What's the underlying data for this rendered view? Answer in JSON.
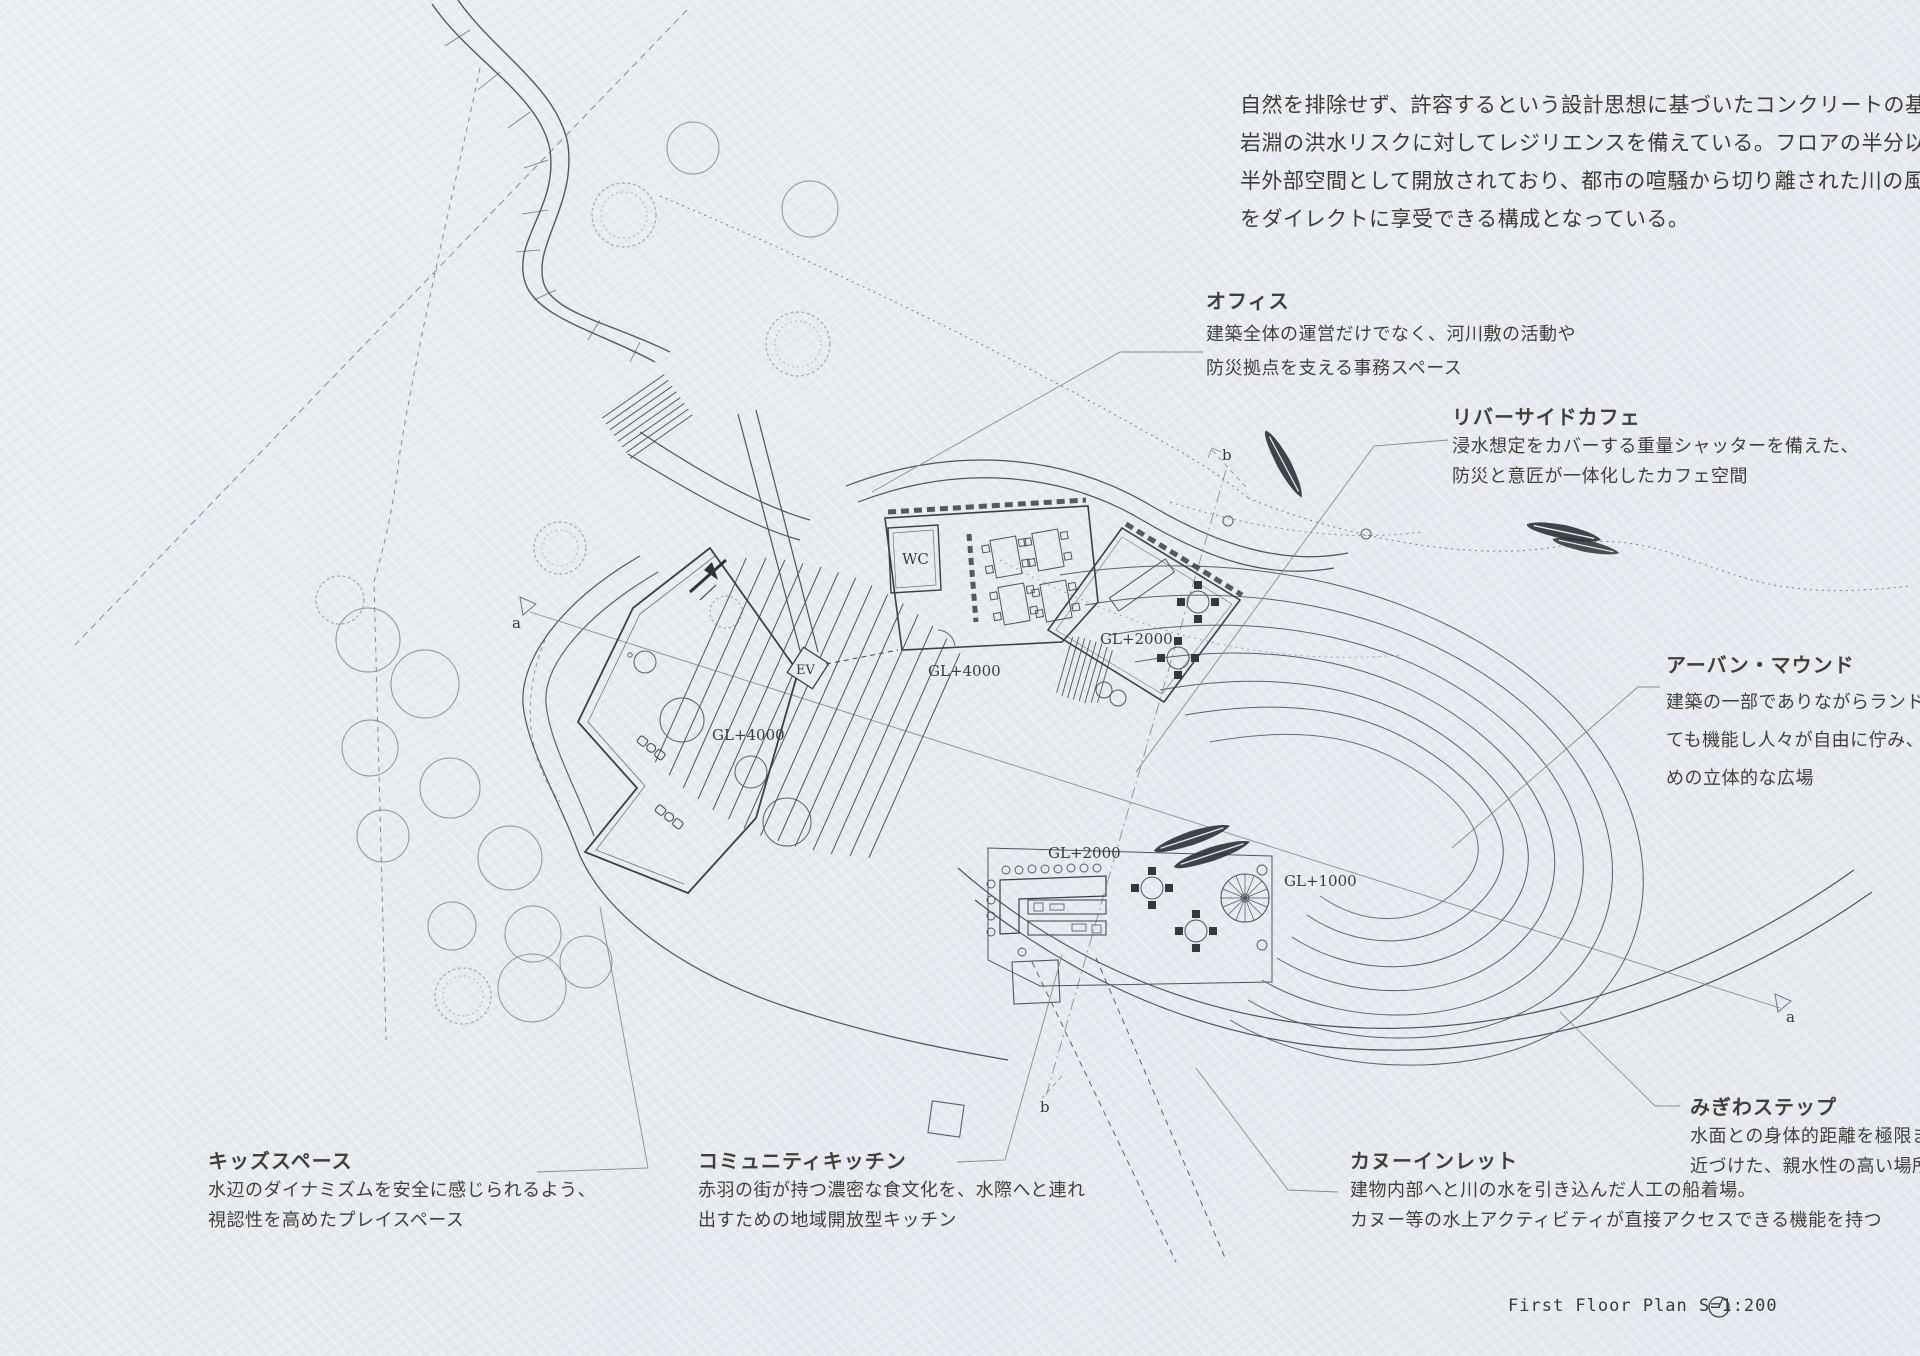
{
  "page": {
    "background": "#e8ecf1",
    "line_color": "#4b4f55",
    "green_color": "#9cb98f",
    "text_color": "#443e39"
  },
  "intro": {
    "lines": [
      "自然を排除せず、許容するという設計思想に基づいたコンクリートの基壇であり、",
      "岩淵の洪水リスクに対してレジリエンスを備えている。フロアの半分以上が外部・",
      "半外部空間として開放されており、都市の喧騒から切り離された川の風や水の音",
      "をダイレクトに享受できる構成となっている。"
    ]
  },
  "annotations": {
    "office": {
      "title": "オフィス",
      "lines": [
        "建築全体の運営だけでなく、河川敷の活動や",
        "防災拠点を支える事務スペース"
      ]
    },
    "riverside_cafe": {
      "title": "リバーサイドカフェ",
      "lines": [
        "浸水想定をカバーする重量シャッターを備えた、",
        "防災と意匠が一体化したカフェ空間"
      ]
    },
    "urban_mound": {
      "title": "アーバン・マウンド",
      "lines": [
        "建築の一部でありながらランドスケープ",
        "ても機能し人々が自由に佇み、川を眺め",
        "めの立体的な広場"
      ]
    },
    "kids_space": {
      "title": "キッズスペース",
      "lines": [
        "水辺のダイナミズムを安全に感じられるよう、",
        "視認性を高めたプレイスペース"
      ]
    },
    "community_kitchen": {
      "title": "コミュニティキッチン",
      "lines": [
        "赤羽の街が持つ濃密な食文化を、水際へと連れ",
        "出すための地域開放型キッチン"
      ]
    },
    "canoe_inlet": {
      "title": "カヌーインレット",
      "lines": [
        "建物内部へと川の水を引き込んだ人工の船着場。",
        "カヌー等の水上アクティビティが直接アクセスできる機能を持つ"
      ]
    },
    "migiwa_step": {
      "title": "みぎわステップ",
      "lines": [
        "水面との身体的距離を極限まで",
        "近づけた、親水性の高い場所"
      ]
    }
  },
  "plan_labels": {
    "wc": "WC",
    "ev": "EV",
    "gl4000": "GL+4000",
    "gl2000": "GL+2000",
    "gl1000": "GL+1000",
    "section_a": "a",
    "section_b": "b"
  },
  "title_block": {
    "title": "First Floor Plan S=1:200"
  }
}
